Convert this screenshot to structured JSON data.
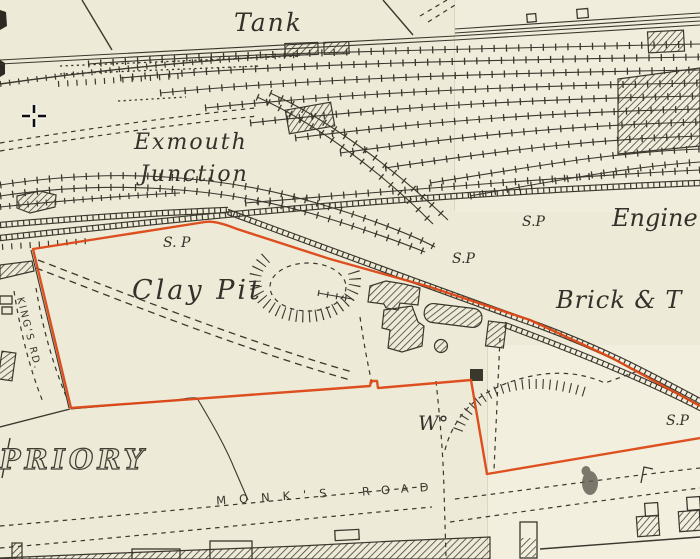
{
  "map": {
    "labels": {
      "tank": "Tank",
      "exmouth_line1": "Exmouth",
      "exmouth_line2": "Junction",
      "clay_pit": "Clay Pit",
      "engine": "Engine",
      "brick_works": "Brick & T",
      "sp_apex": "S. P",
      "sp_main": "S.P",
      "sp_mid": "S.P",
      "sp_right": "S.P",
      "w_mark": "W°",
      "priory": "OE PRIORY",
      "monks": "MONK'S",
      "road": "ROAD",
      "kings_rd": "KING'S RD."
    },
    "colors": {
      "paper": "#eeead8",
      "ink": "#3a372d",
      "boundary": "#dc4715"
    },
    "cursor_icon": "crosshair-cursor"
  }
}
